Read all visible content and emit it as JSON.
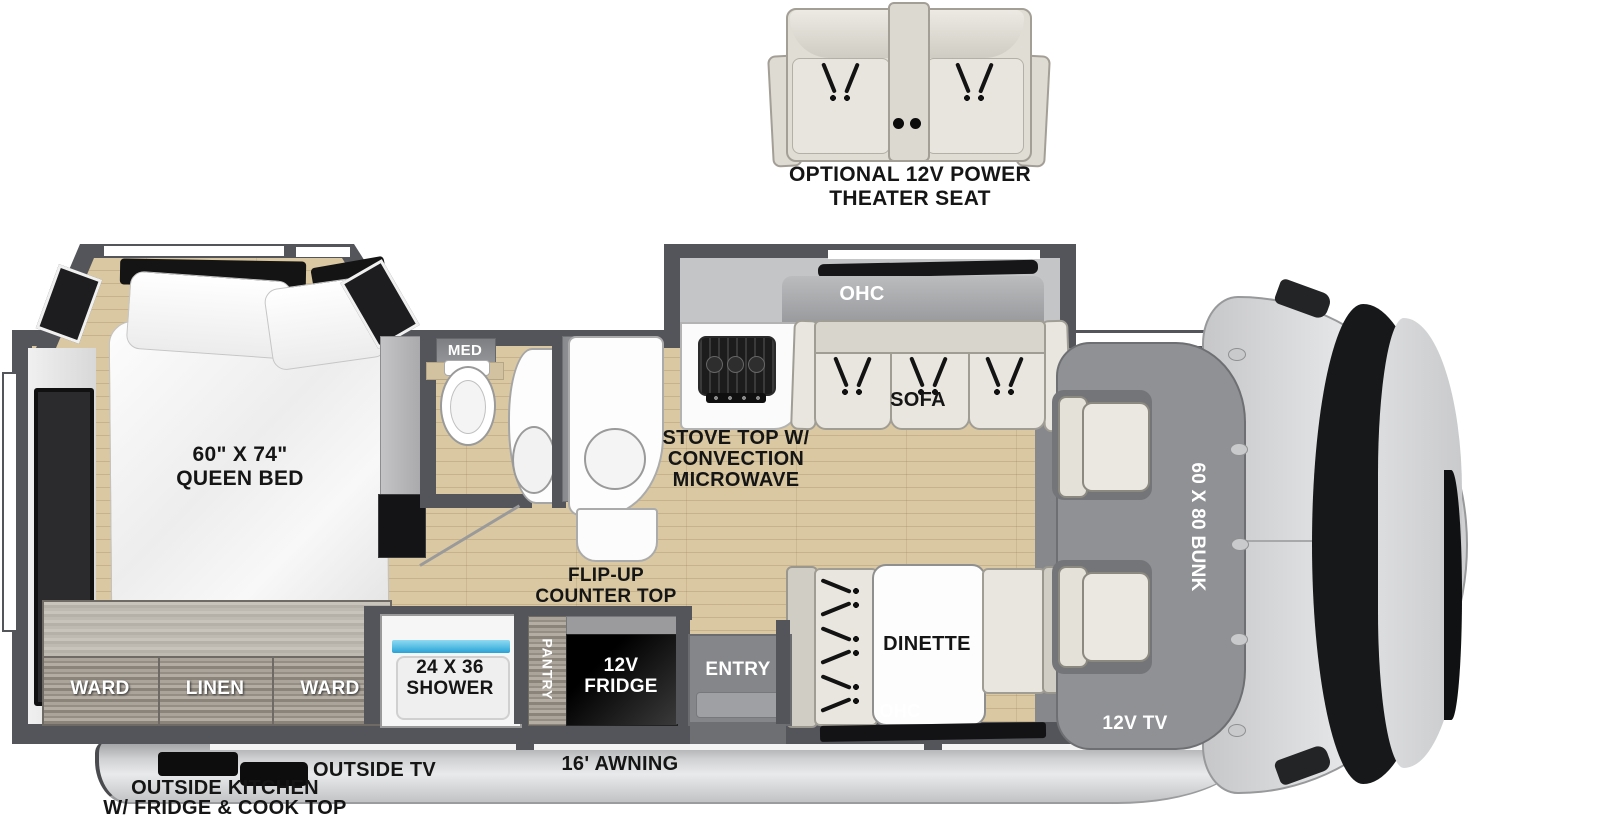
{
  "floorplan": {
    "theater_seat": {
      "label_line1": "OPTIONAL 12V POWER",
      "label_line2": "THEATER SEAT"
    },
    "bedroom": {
      "queen_bed_line1": "60\" X 74\"",
      "queen_bed_line2": "QUEEN BED",
      "ward_left": "WARD",
      "linen": "LINEN",
      "ward_right": "WARD"
    },
    "bathroom": {
      "med_cabinet": "MED",
      "overhead_cabinet": "OHC",
      "shower_line1": "24 X 36",
      "shower_line2": "SHOWER"
    },
    "kitchen": {
      "stove_line1": "STOVE TOP W/",
      "stove_line2": "CONVECTION",
      "stove_line3": "MICROWAVE",
      "flip_up_line1": "FLIP-UP",
      "flip_up_line2": "COUNTER TOP",
      "pantry": "PANTRY",
      "fridge_line1": "12V",
      "fridge_line2": "FRIDGE"
    },
    "living_area": {
      "sofa_ohc": "OHC",
      "sofa": "SOFA",
      "dinette": "DINETTE",
      "dinette_ohc": "OHC",
      "entry": "ENTRY"
    },
    "cab": {
      "bunk": "60 X 80 BUNK",
      "tv": "12V TV"
    },
    "exterior": {
      "outside_tv": "OUTSIDE TV",
      "outside_kitchen_line1": "OUTSIDE KITCHEN",
      "outside_kitchen_line2": "W/ FRIDGE & COOK TOP",
      "awning": "16' AWNING"
    }
  },
  "colors": {
    "wall": "#54555a",
    "floor_wood": "#d9c8a2",
    "cabinet_wood": "#9c958b",
    "furniture_cream": "#e8e6df",
    "shower_glass_blue": "#3fb9e4",
    "body_silver": "#d5d6d8",
    "bunk_gray": "#8f9194"
  }
}
